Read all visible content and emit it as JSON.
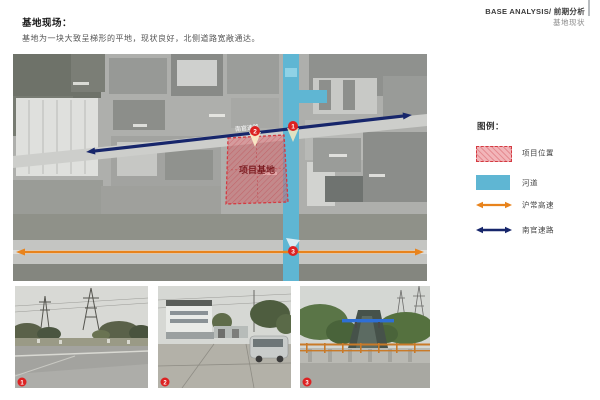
{
  "header": {
    "heading": "基地现场：",
    "description": "基地为一块大致呈梯形的平地，现状良好，北侧道路宽敞通达。",
    "right_line1": "BASE ANALYSIS/ 前期分析",
    "right_line2": "基地现状"
  },
  "map": {
    "site_label": "项目基地",
    "road_label": "南官速路",
    "markers": [
      {
        "id": "1"
      },
      {
        "id": "2"
      },
      {
        "id": "3"
      }
    ]
  },
  "legend": {
    "title": "图例：",
    "items": [
      {
        "label": "项目位置",
        "swatch": "site-hatched-box"
      },
      {
        "label": "河道",
        "swatch": "river-box"
      },
      {
        "label": "沪常高速",
        "swatch": "orange-double-arrow"
      },
      {
        "label": "南官速路",
        "swatch": "navy-double-arrow"
      }
    ]
  },
  "photos": [
    {
      "number": "1",
      "subject": "road with power transmission towers"
    },
    {
      "number": "2",
      "subject": "factory entrance with van"
    },
    {
      "number": "3",
      "subject": "canal seen from bridge with orange railing"
    }
  ],
  "colors": {
    "site_fill": "#e87880",
    "site_border": "#d43a41",
    "river": "#5fb6d3",
    "expressway_arrow": "#e8831c",
    "road_arrow": "#17266b",
    "marker_red": "#dd2222"
  }
}
